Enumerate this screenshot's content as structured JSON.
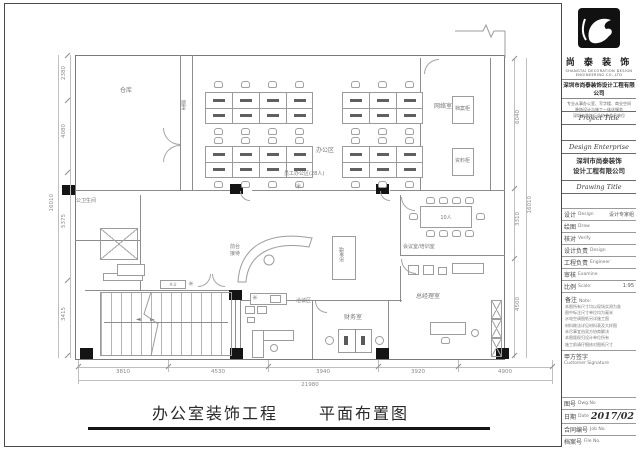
{
  "footer": {
    "project": "办公室装饰工程",
    "drawing": "平面布置图"
  },
  "icons": {
    "fan": "✳",
    "stair_arrow_left": "◄",
    "stair_arrow_right": "►"
  },
  "plan": {
    "labels": {
      "storage": "仓库",
      "corridor": "走廊",
      "office_area": "办公区",
      "office_count": "员工办公区(28人)",
      "network": "网络室",
      "cabinet1": "档案柜",
      "cabinet2": "资料柜",
      "meeting_table": "10人",
      "meeting": "会议室/培训室",
      "gm": "总经理室",
      "finance": "财务室",
      "negotiation": "洽谈区",
      "reception_l1": "前台",
      "reception_l2": "接待",
      "logo_wall": "形象墙",
      "restroom": "公卫生间",
      "equipment": "A.U"
    },
    "dimensions": {
      "bottom": [
        "3810",
        "4530",
        "3940",
        "3920",
        "4900"
      ],
      "bottom_total": "21980",
      "left": [
        "2380",
        "4080",
        "5375",
        "3415"
      ],
      "left_total": "16010",
      "right": [
        "6040",
        "3310",
        "4500"
      ],
      "right_total": "16010"
    }
  },
  "title_block": {
    "brand_name": "尚 泰 装 饰",
    "brand_en": "SHANGTAI DECORATION DESIGN ENGINEERING CO.,LTD",
    "company_full": "深圳市尚泰装饰设计工程有限公司",
    "info_lines": [
      "专业从事办公室、写字楼、商业空间",
      "装饰设计与施工一体化服务",
      "深圳市装饰行业协会会员单位"
    ],
    "section_project": "Project Title",
    "section_enterprise": "Design Enterprise",
    "enterprise_line1": "深圳市尚泰装饰",
    "enterprise_line2": "设计工程有限公司",
    "section_drawing": "Drawing Title",
    "rows": {
      "design_label": "设计",
      "design_en": "Design",
      "design_value": "设计专家组",
      "draw_label": "绘图",
      "draw_en": "Draw",
      "verify_label": "核对",
      "verify_en": "Verify",
      "design_lead_label": "设计负责",
      "design_lead_en": "Design",
      "engineer_label": "工程负责",
      "engineer_en": "Engineer",
      "examine_label": "审核",
      "examine_en": "Examine",
      "scale_label": "比例",
      "scale_en": "Scale:",
      "scale_value": "1:95"
    },
    "note_label": "备注",
    "note_en": "Note:",
    "notes": [
      "本图所有尺寸均以现场实测为准",
      "图中标注尺寸单位均为毫米",
      "水电空调图纸另详施工图",
      "材料做法详见材料表及大样图",
      "未尽事宜由双方协商解决",
      "本图版权归设计单位所有",
      "施工前请仔细核对图纸尺寸"
    ],
    "signature_label": "甲方签字",
    "signature_en": "Customer Signature",
    "bottom_rows": {
      "dwg_label": "图号",
      "dwg_en": "Dwg.No",
      "date_label": "日期",
      "date_en": "Date",
      "date_value": "2017/02",
      "job_label": "合同编号",
      "job_en": "Job No.",
      "file_label": "档案号",
      "file_en": "File No."
    }
  }
}
